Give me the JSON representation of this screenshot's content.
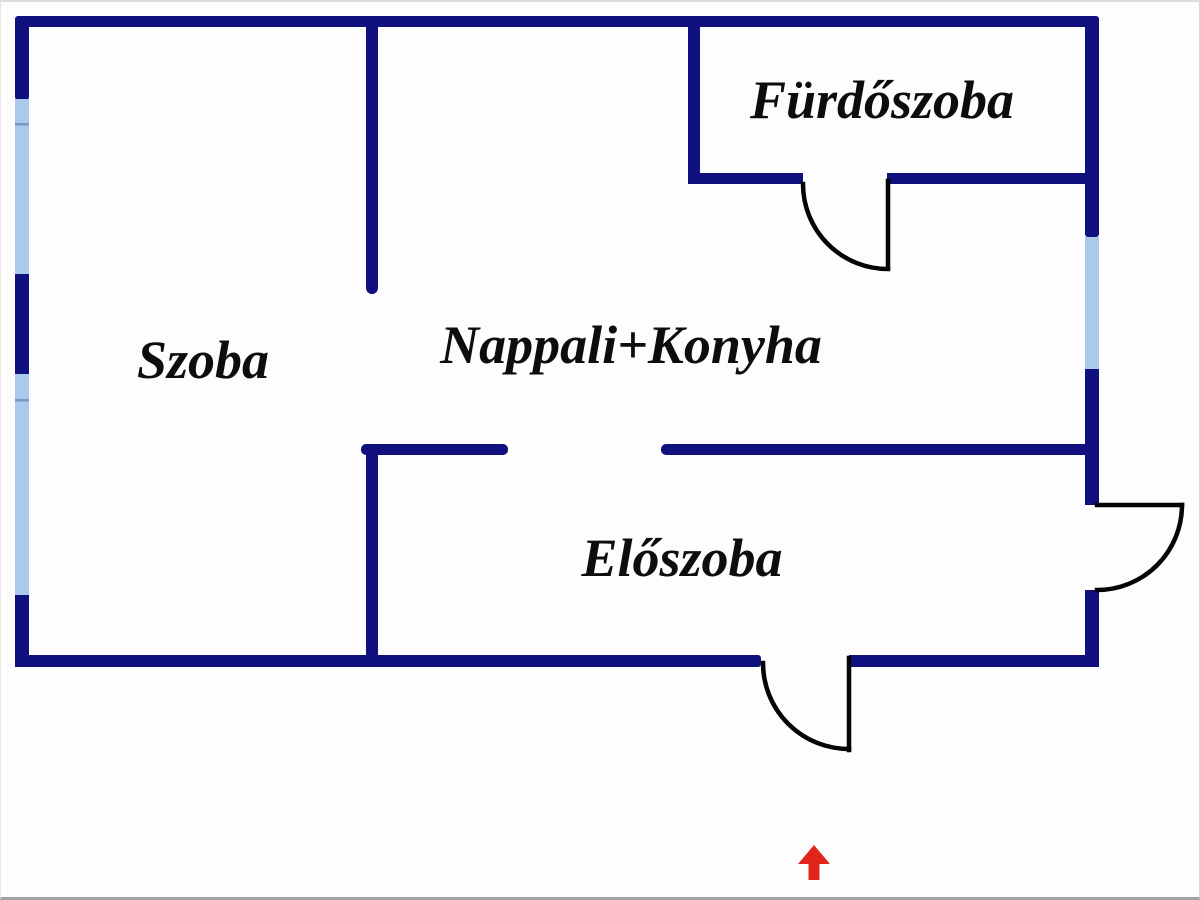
{
  "plan": {
    "type": "apartment-floor-plan",
    "rooms": {
      "szoba": {
        "label": "Szoba"
      },
      "nappali_konyha": {
        "label": "Nappali+Konyha"
      },
      "furdoszoba": {
        "label": "Fürdőszoba"
      },
      "eloszoba": {
        "label": "Előszoba"
      }
    },
    "entrance": {
      "icon": "entrance-arrow-up",
      "direction": "up"
    }
  },
  "colors": {
    "wall": "#10107e",
    "window": "#a9caec",
    "window_divider": "#7f93bc",
    "door_line": "#050505",
    "arrow_red": "#e0251c",
    "text": "#0d0d0d"
  }
}
